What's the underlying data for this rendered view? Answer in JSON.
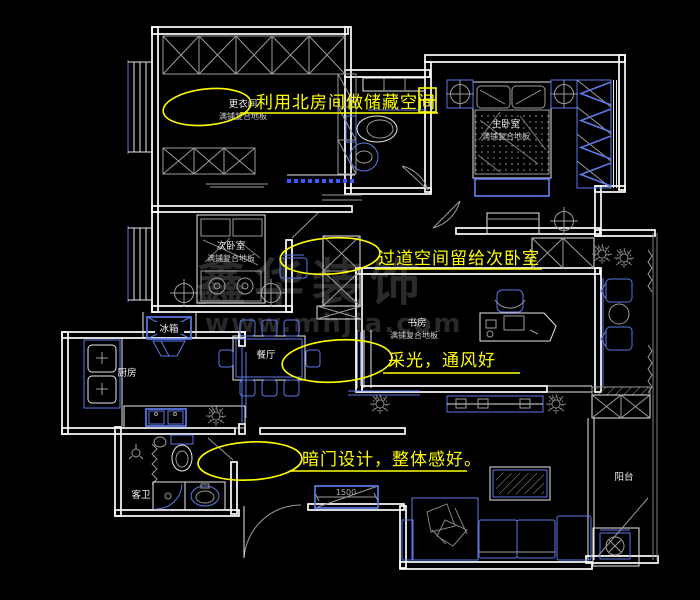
{
  "colors": {
    "background": "#000000",
    "walls": "#ffffff",
    "furniture_accent": "#5b79e6",
    "detail_gray": "#9b9b9b",
    "annotation_yellow": "#ffff00",
    "watermark_gray": "#2b2b2b"
  },
  "annotations": {
    "note1": "利用北房间做储藏空间",
    "note2": "过道空间留给次卧室",
    "note3": "采光，通风好",
    "note4": "暗门设计，整体感好。"
  },
  "rooms": {
    "dressing": {
      "name": "更衣间",
      "floor": "满铺复合地板"
    },
    "master_bedroom": {
      "name": "主卧室",
      "floor": "满铺复合地板"
    },
    "second_bedroom": {
      "name": "次卧室",
      "floor": "满铺复合地板"
    },
    "study": {
      "name": "书房",
      "floor": "满铺复合地板"
    },
    "dining": {
      "name": "餐厅"
    },
    "kitchen": {
      "name": "厨房"
    },
    "guest_bath": {
      "name": "客卫"
    },
    "balcony": {
      "name": "阳台"
    },
    "fridge": {
      "name": "冰箱"
    }
  },
  "dimensions": {
    "hidden_door_width": "1500"
  },
  "watermark": {
    "line1": "鑫华装饰",
    "line2": "www.mhjia.com"
  }
}
